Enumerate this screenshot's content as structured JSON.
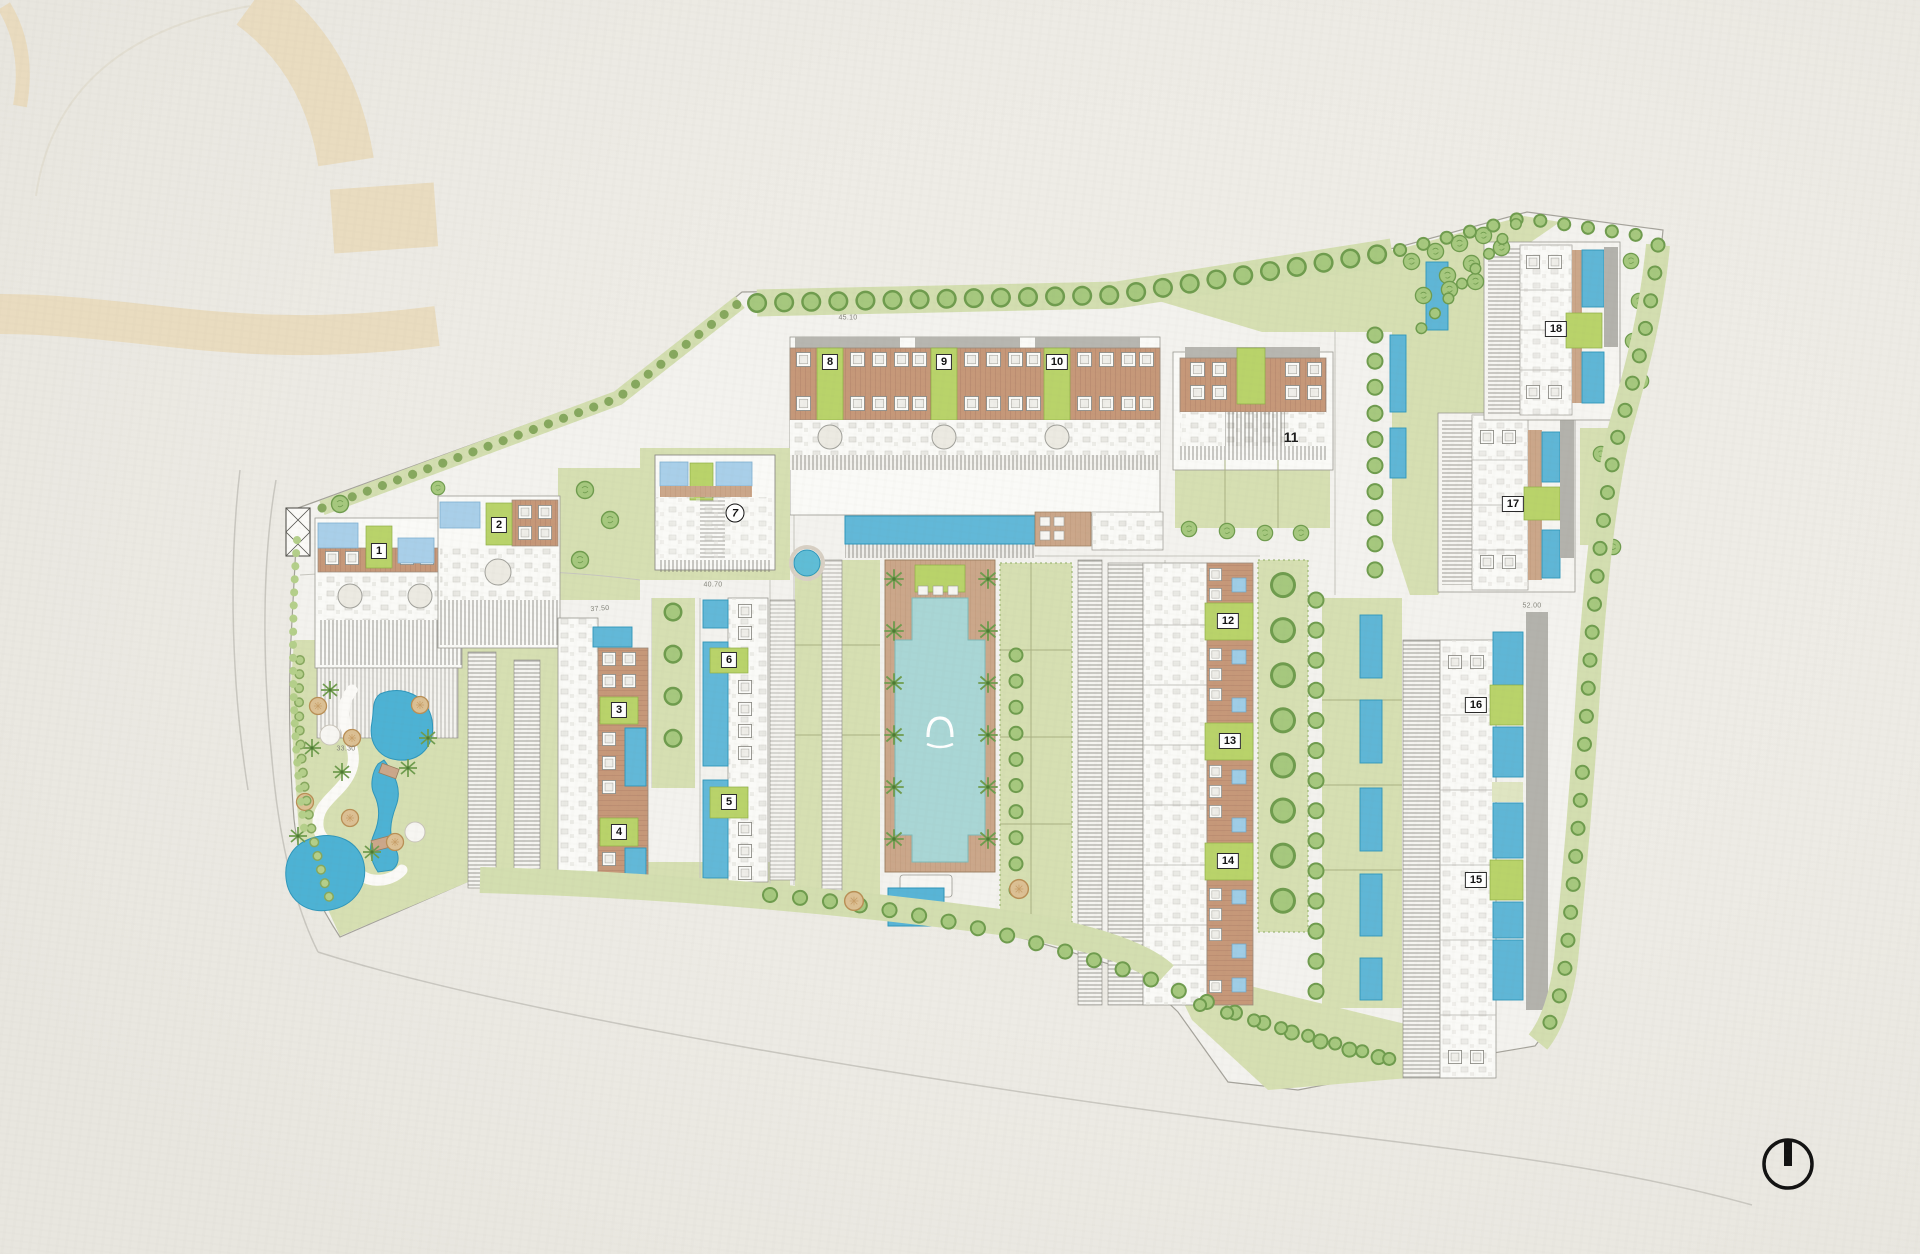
{
  "plan": {
    "type": "resort-master-plan",
    "buildings": [
      {
        "label": "1"
      },
      {
        "label": "2"
      },
      {
        "label": "3"
      },
      {
        "label": "4"
      },
      {
        "label": "5"
      },
      {
        "label": "6"
      },
      {
        "label": "7"
      },
      {
        "label": "8"
      },
      {
        "label": "9"
      },
      {
        "label": "10"
      },
      {
        "label": "11"
      },
      {
        "label": "12"
      },
      {
        "label": "13"
      },
      {
        "label": "14"
      },
      {
        "label": "15"
      },
      {
        "label": "16"
      },
      {
        "label": "17"
      },
      {
        "label": "18"
      }
    ],
    "annotations": {
      "elevations": [
        {
          "text": "45.10"
        },
        {
          "text": "40.70"
        },
        {
          "text": "37.50"
        },
        {
          "text": "33.30"
        },
        {
          "text": "52.00"
        }
      ]
    },
    "icons": {
      "compass": "north-indicator-icon",
      "watermark": "arch-logo-watermark",
      "pool_logo": "arch-logo-mark"
    },
    "colors": {
      "paper": "#edebe5",
      "watermark_beige": "#e8dabb",
      "site_fill": "#f3f2ee",
      "lawn": "#d6dfb2",
      "label_patch_green": "#b9d36a",
      "tree_green": "#a6c87e",
      "tree_outline": "#6f9c4e",
      "pool_blue": "#62b8d8",
      "rooftop_pool_blue": "#a9cfe9",
      "courtyard_pool_teal": "#a9d6d5",
      "lagoon_blue": "#4db2d4",
      "terracotta": "#c69879",
      "deck_tan": "#cba78a",
      "roof_gray": "#b7b6b0",
      "line_gray": "#8d8c86"
    }
  }
}
